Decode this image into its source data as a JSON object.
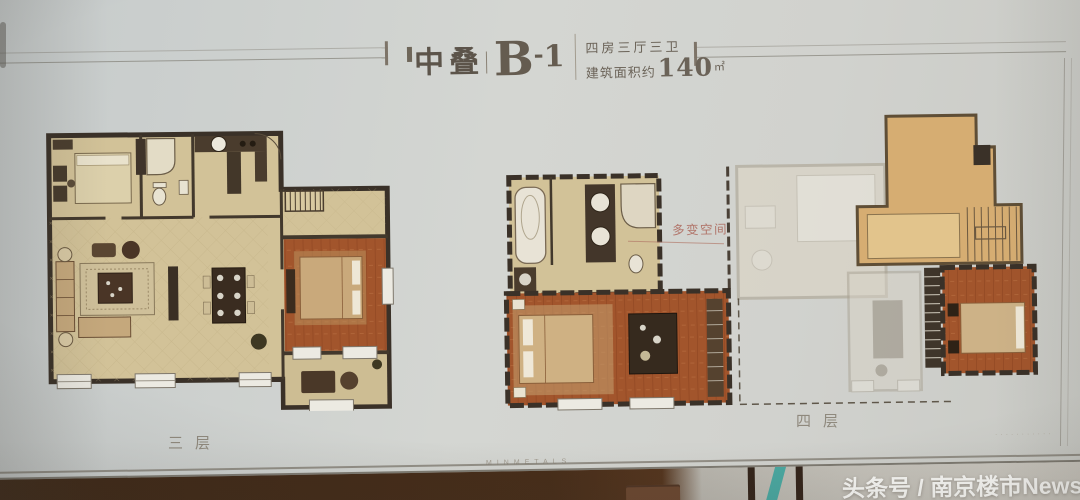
{
  "header": {
    "title_cn": "中叠",
    "code_letter": "B",
    "code_dash": "-",
    "code_digit": "1",
    "spec_line": "四房三厅三卫",
    "area_prefix": "建筑面积约",
    "area_value": "140",
    "area_unit": "㎡"
  },
  "plans": {
    "left_label": "三层",
    "right_label": "四层",
    "flex_space_label": "多变空间"
  },
  "footer": {
    "brand_faint": "MINMETALS",
    "corner_faint": "···········",
    "watermark": "头条号 / 南京楼市News"
  },
  "colors": {
    "floor_beige": "#d2c298",
    "floor_wood": "#a2552c",
    "wall_dark": "#3a3128",
    "terrace_tan": "#d6ad72",
    "flex_label_color": "#b1756a",
    "teal_strip": "#4aa9a2",
    "watermark_color": "#fafaf7"
  }
}
